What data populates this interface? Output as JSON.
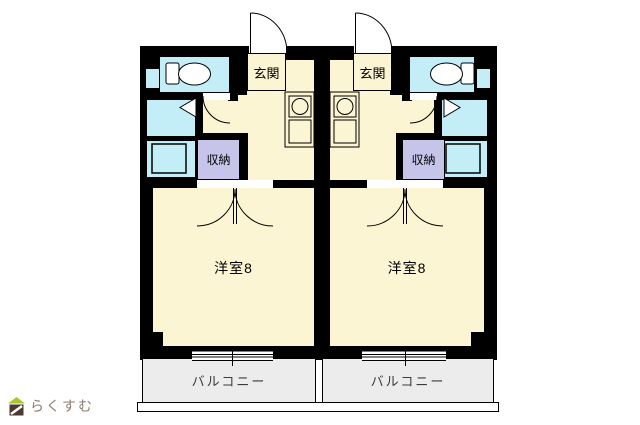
{
  "floorplan": {
    "units": [
      {
        "entrance": "玄関",
        "closet": "収納",
        "room": "洋室8",
        "balcony": "バルコニー"
      },
      {
        "entrance": "玄関",
        "closet": "収納",
        "room": "洋室8",
        "balcony": "バルコニー"
      }
    ],
    "watermark": "らくすむ",
    "colors": {
      "floor": "#FBF5D3",
      "wet_rooms": "#C3EEF7",
      "closet": "#C7C4EA",
      "balcony": "#ECECEC",
      "wall": "#000000",
      "watermark_text": "#8D7E70",
      "logo_roof": "#A9C62B",
      "logo_body": "#4A3A30"
    }
  }
}
